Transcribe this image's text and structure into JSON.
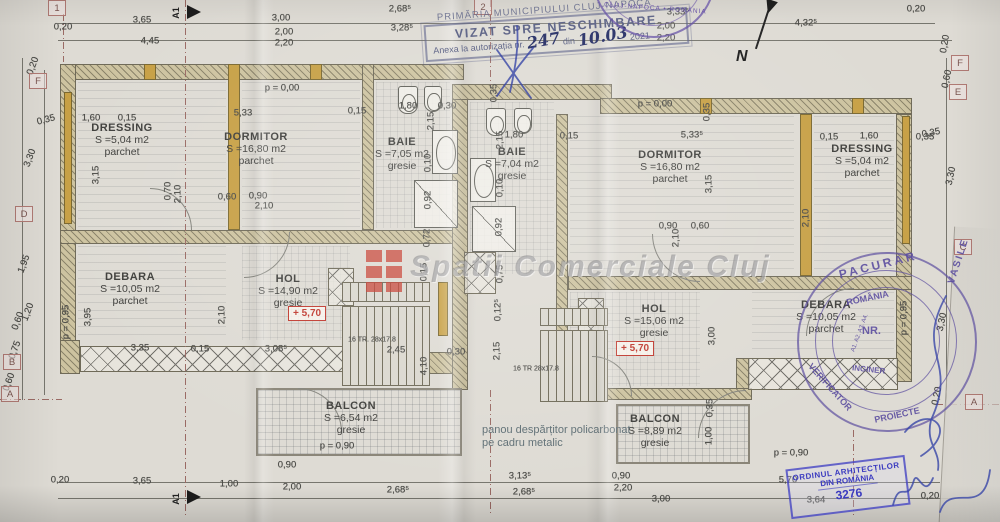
{
  "stamps": {
    "vizat": {
      "municipality": "PRIMĂRIA MUNICIPIULUI CLUJ-NAPOCA",
      "title": "VIZAT SPRE NESCHIMBARE",
      "annex": "Anexa la autorizația nr.",
      "number": "247",
      "din": "din",
      "date": "10.03",
      "year": "2021"
    },
    "round_top": {
      "text": "CLUJ-NAPOCA • ROMÂNIA"
    },
    "verifier": {
      "name_top": "PACURAR",
      "name_side": "VASILE",
      "role_bottom": "VERIFICATOR",
      "role_bottom2": "PROIECTE",
      "country": "ROMÂNIA",
      "nr": "NR.",
      "categories": "A1. A2. A3. A4.",
      "title": "INGINER"
    },
    "architects": {
      "line1": "ORDINUL ARHITECȚILOR",
      "line2": "DIN ROMÂNIA",
      "number": "3276"
    }
  },
  "watermark": {
    "text": "Spatii Comerciale Cluj"
  },
  "compass": {
    "label": "N"
  },
  "section": {
    "label": "A1"
  },
  "note": {
    "line1": "panou despărțitor policarbonat",
    "line2": "pe cadru metalic"
  },
  "rooms": [
    {
      "name": "DRESSING",
      "area": "S =5,04 m2",
      "floor": "parchet"
    },
    {
      "name": "DORMITOR",
      "area": "S =16,80 m2",
      "floor": "parchet"
    },
    {
      "name": "BAIE",
      "area": "S =7,05 m2",
      "floor": "gresie"
    },
    {
      "name": "BAIE",
      "area": "S =7,04 m2",
      "floor": "gresie"
    },
    {
      "name": "DORMITOR",
      "area": "S =16,80 m2",
      "floor": "parchet"
    },
    {
      "name": "DRESSING",
      "area": "S =5,04 m2",
      "floor": "parchet"
    },
    {
      "name": "DEBARA",
      "area": "S =10,05 m2",
      "floor": "parchet"
    },
    {
      "name": "HOL",
      "area": "S =14,90 m2",
      "floor": "gresie",
      "level": "+ 5,70"
    },
    {
      "name": "HOL",
      "area": "S =15,06 m2",
      "floor": "gresie",
      "level": "+ 5,70"
    },
    {
      "name": "DEBARA",
      "area": "S =10,05 m2",
      "floor": "parchet"
    },
    {
      "name": "BALCON",
      "area": "S =6,54 m2",
      "floor": "gresie"
    },
    {
      "name": "BALCON",
      "area": "S =8,89 m2",
      "floor": "gresie"
    }
  ],
  "stair_labels": [
    {
      "t": "16 TR. 28x17.8",
      "x": 372,
      "y": 340
    },
    {
      "t": "16 TR 28x17.8",
      "x": 536,
      "y": 369
    }
  ],
  "axes": [
    {
      "t": "1",
      "x": 57,
      "y": 8
    },
    {
      "t": "2",
      "x": 483,
      "y": 7
    },
    {
      "t": "F",
      "x": 38,
      "y": 81
    },
    {
      "t": "D",
      "x": 24,
      "y": 214
    },
    {
      "t": "B",
      "x": 12,
      "y": 362
    },
    {
      "t": "A",
      "x": 10,
      "y": 394
    },
    {
      "t": "F",
      "x": 960,
      "y": 63
    },
    {
      "t": "E",
      "x": 958,
      "y": 92
    },
    {
      "t": "C",
      "x": 963,
      "y": 247
    },
    {
      "t": "A",
      "x": 974,
      "y": 402
    }
  ],
  "dims": [
    {
      "t": "0,20",
      "x": 63,
      "y": 27
    },
    {
      "t": "3,65",
      "x": 142,
      "y": 20
    },
    {
      "t": "4,45",
      "x": 150,
      "y": 41
    },
    {
      "t": "3,00",
      "x": 281,
      "y": 18
    },
    {
      "t": "2,00",
      "x": 284,
      "y": 32
    },
    {
      "t": "2,20",
      "x": 284,
      "y": 43
    },
    {
      "t": "2,68⁵",
      "x": 400,
      "y": 9
    },
    {
      "t": "3,28⁵",
      "x": 402,
      "y": 28
    },
    {
      "t": "3,33⁵",
      "x": 678,
      "y": 12
    },
    {
      "t": "2,00",
      "x": 666,
      "y": 26
    },
    {
      "t": "2,20",
      "x": 666,
      "y": 38
    },
    {
      "t": "4,32⁵",
      "x": 806,
      "y": 23
    },
    {
      "t": "0,20",
      "x": 916,
      "y": 9
    },
    {
      "t": "0,20",
      "x": 945,
      "y": 44,
      "r": -80
    },
    {
      "t": "0,20",
      "x": 33,
      "y": 66,
      "r": -70
    },
    {
      "t": "0,35",
      "x": 46,
      "y": 120,
      "r": -15
    },
    {
      "t": "3,30",
      "x": 30,
      "y": 158,
      "r": -70
    },
    {
      "t": "1,95",
      "x": 24,
      "y": 264,
      "r": -70
    },
    {
      "t": "1,20",
      "x": 28,
      "y": 312,
      "r": -70
    },
    {
      "t": "0,60",
      "x": 18,
      "y": 321,
      "r": -70
    },
    {
      "t": "0,75",
      "x": 15,
      "y": 350,
      "r": -70
    },
    {
      "t": "0,60",
      "x": 9,
      "y": 382,
      "r": -70
    },
    {
      "t": "0,60",
      "x": 947,
      "y": 79,
      "r": -78
    },
    {
      "t": "0,35",
      "x": 931,
      "y": 133,
      "r": -10
    },
    {
      "t": "3,30",
      "x": 951,
      "y": 176,
      "r": -78
    },
    {
      "t": "3,30",
      "x": 942,
      "y": 322,
      "r": -78
    },
    {
      "t": "0,20",
      "x": 937,
      "y": 396,
      "r": -78
    },
    {
      "t": "0,20",
      "x": 60,
      "y": 480
    },
    {
      "t": "3,65",
      "x": 142,
      "y": 481
    },
    {
      "t": "1,00",
      "x": 229,
      "y": 484
    },
    {
      "t": "2,00",
      "x": 292,
      "y": 487
    },
    {
      "t": "2,68⁵",
      "x": 398,
      "y": 490
    },
    {
      "t": "3,13⁵",
      "x": 520,
      "y": 476
    },
    {
      "t": "2,68⁵",
      "x": 524,
      "y": 492
    },
    {
      "t": "0,90",
      "x": 621,
      "y": 476
    },
    {
      "t": "2,20",
      "x": 623,
      "y": 488
    },
    {
      "t": "3,00",
      "x": 661,
      "y": 499
    },
    {
      "t": "5,70",
      "x": 788,
      "y": 480
    },
    {
      "t": "3,64",
      "x": 816,
      "y": 500
    },
    {
      "t": "0,20",
      "x": 930,
      "y": 496
    },
    {
      "t": "p = 0,00",
      "x": 282,
      "y": 88
    },
    {
      "t": "p = 0,00",
      "x": 655,
      "y": 104
    },
    {
      "t": "1,60",
      "x": 91,
      "y": 118
    },
    {
      "t": "0,15",
      "x": 127,
      "y": 118
    },
    {
      "t": "5,33",
      "x": 243,
      "y": 113
    },
    {
      "t": "3,15",
      "x": 96,
      "y": 175,
      "r": -90
    },
    {
      "t": "0,15",
      "x": 357,
      "y": 111
    },
    {
      "t": "1,80",
      "x": 408,
      "y": 106
    },
    {
      "t": "0,30",
      "x": 447,
      "y": 106
    },
    {
      "t": "2,15",
      "x": 431,
      "y": 121,
      "r": -90
    },
    {
      "t": "0,35",
      "x": 494,
      "y": 93,
      "r": -90
    },
    {
      "t": "2,15",
      "x": 500,
      "y": 140,
      "r": -90
    },
    {
      "t": "1,80",
      "x": 514,
      "y": 135
    },
    {
      "t": "0,15",
      "x": 569,
      "y": 136
    },
    {
      "t": "5,33⁵",
      "x": 692,
      "y": 135
    },
    {
      "t": "0,35",
      "x": 707,
      "y": 112,
      "r": -90
    },
    {
      "t": "3,15",
      "x": 709,
      "y": 184,
      "r": -90
    },
    {
      "t": "0,15",
      "x": 829,
      "y": 137
    },
    {
      "t": "1,60",
      "x": 869,
      "y": 136
    },
    {
      "t": "0,35",
      "x": 925,
      "y": 137
    },
    {
      "t": "0,10",
      "x": 428,
      "y": 163,
      "r": -90
    },
    {
      "t": "0,92",
      "x": 428,
      "y": 200,
      "r": -90
    },
    {
      "t": "0,10",
      "x": 500,
      "y": 188,
      "r": -90
    },
    {
      "t": "0,92",
      "x": 499,
      "y": 227,
      "r": -90
    },
    {
      "t": "0,72",
      "x": 427,
      "y": 238,
      "r": -90
    },
    {
      "t": "0,75",
      "x": 500,
      "y": 274,
      "r": -90
    },
    {
      "t": "0,15",
      "x": 424,
      "y": 272,
      "r": -90
    },
    {
      "t": "0,70",
      "x": 168,
      "y": 191,
      "r": -90
    },
    {
      "t": "2,10",
      "x": 178,
      "y": 194,
      "r": -90
    },
    {
      "t": "0,60",
      "x": 227,
      "y": 197
    },
    {
      "t": "0,90",
      "x": 258,
      "y": 196
    },
    {
      "t": "2,10",
      "x": 264,
      "y": 206
    },
    {
      "t": "0,90",
      "x": 668,
      "y": 226
    },
    {
      "t": "0,60",
      "x": 700,
      "y": 226
    },
    {
      "t": "2,10",
      "x": 676,
      "y": 238,
      "r": -90
    },
    {
      "t": "2,10",
      "x": 806,
      "y": 218,
      "r": -90
    },
    {
      "t": "p = 0,95",
      "x": 66,
      "y": 322,
      "r": -90
    },
    {
      "t": "3,95",
      "x": 88,
      "y": 317,
      "r": -90
    },
    {
      "t": "2,10",
      "x": 222,
      "y": 315,
      "r": -90
    },
    {
      "t": "3,35",
      "x": 140,
      "y": 348
    },
    {
      "t": "0,15",
      "x": 200,
      "y": 349
    },
    {
      "t": "3,08⁵",
      "x": 276,
      "y": 349
    },
    {
      "t": "2,45",
      "x": 396,
      "y": 350
    },
    {
      "t": "0,30",
      "x": 456,
      "y": 352
    },
    {
      "t": "2,15",
      "x": 497,
      "y": 351,
      "r": -90
    },
    {
      "t": "4,10",
      "x": 424,
      "y": 366,
      "r": -90
    },
    {
      "t": "0,12⁵",
      "x": 498,
      "y": 310,
      "r": -90
    },
    {
      "t": "3,00",
      "x": 712,
      "y": 336,
      "r": -90
    },
    {
      "t": "p = 0,95",
      "x": 904,
      "y": 318,
      "r": -90
    },
    {
      "t": "0,35",
      "x": 710,
      "y": 408,
      "r": -90
    },
    {
      "t": "1,00",
      "x": 709,
      "y": 436,
      "r": -90
    },
    {
      "t": "p = 0,90",
      "x": 337,
      "y": 446
    },
    {
      "t": "p = 0,90",
      "x": 791,
      "y": 453
    },
    {
      "t": "0,90",
      "x": 287,
      "y": 465
    }
  ]
}
